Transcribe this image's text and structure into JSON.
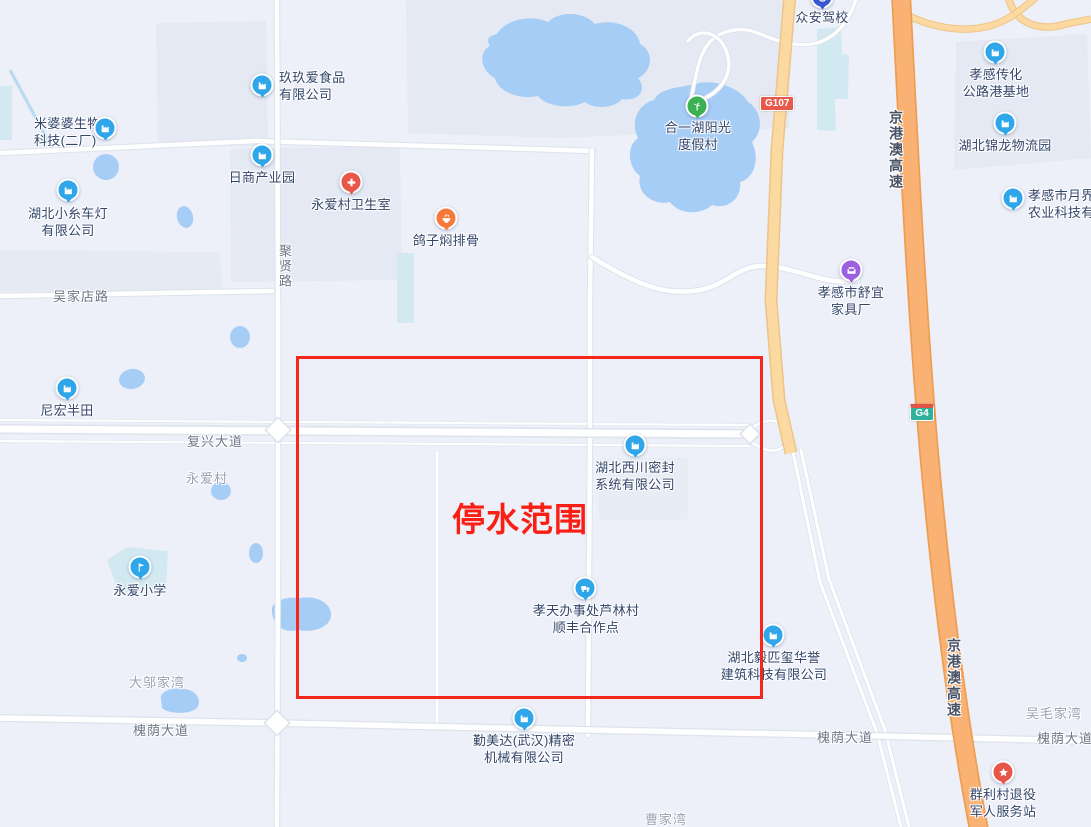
{
  "map": {
    "annotation": {
      "text": "停水范围",
      "color": "#f5261c"
    },
    "shields": [
      {
        "text": "G107"
      },
      {
        "text": "G4"
      }
    ],
    "road_labels": [
      {
        "text": "聚贤路"
      },
      {
        "text": "吴家店路"
      },
      {
        "text": "复兴大道"
      },
      {
        "text": "槐荫大道"
      },
      {
        "text": "槐荫大道"
      },
      {
        "text": "槐荫大道"
      },
      {
        "text": "京港澳高速"
      },
      {
        "text": "京港澳高速"
      }
    ],
    "area_labels": [
      {
        "text": "永爱村"
      },
      {
        "text": "大邬家湾"
      },
      {
        "text": "曹家湾"
      },
      {
        "text": "吴毛家湾"
      }
    ],
    "pois": [
      {
        "name": "玖玖爱食品有限公司",
        "lines": [
          "玖玖爱食品",
          "有限公司"
        ],
        "icon": "factory-icon",
        "color": "#2fa6e9"
      },
      {
        "name": "米婆婆生物科技(二厂)",
        "lines": [
          "米婆婆生物",
          "科技(二厂)"
        ],
        "icon": "factory-icon",
        "color": "#2fa6e9"
      },
      {
        "name": "日商产业园",
        "lines": [
          "日商产业园"
        ],
        "icon": "factory-icon",
        "color": "#2fa6e9"
      },
      {
        "name": "湖北小糸车灯有限公司",
        "lines": [
          "湖北小糸车灯",
          "有限公司"
        ],
        "icon": "factory-icon",
        "color": "#2fa6e9"
      },
      {
        "name": "永爱村卫生室",
        "lines": [
          "永爱村卫生室"
        ],
        "icon": "clinic-cross-icon",
        "color": "#e8564a"
      },
      {
        "name": "鸽子焖排骨",
        "lines": [
          "鸽子焖排骨"
        ],
        "icon": "food-bowl-icon",
        "color": "#f5793b"
      },
      {
        "name": "合一湖阳光度假村",
        "lines": [
          "合一湖阳光",
          "度假村"
        ],
        "icon": "palm-tree-icon",
        "color": "#3db054"
      },
      {
        "name": "众安驾校",
        "lines": [
          "众安驾校"
        ],
        "icon": "steering-wheel-icon",
        "color": "#3b57cf"
      },
      {
        "name": "孝感传化公路港基地",
        "lines": [
          "孝感传化",
          "公路港基地"
        ],
        "icon": "factory-icon",
        "color": "#2fa6e9"
      },
      {
        "name": "湖北锦龙物流园",
        "lines": [
          "湖北锦龙物流园"
        ],
        "icon": "factory-icon",
        "color": "#2fa6e9"
      },
      {
        "name": "孝感市月界生农业科技有限",
        "lines": [
          "孝感市月界生",
          "农业科技有限"
        ],
        "icon": "factory-icon",
        "color": "#2fa6e9"
      },
      {
        "name": "孝感市舒宜家具厂",
        "lines": [
          "孝感市舒宜",
          "家具厂"
        ],
        "icon": "furniture-icon",
        "color": "#9b5fe0"
      },
      {
        "name": "尼宏半田",
        "lines": [
          "尼宏半田"
        ],
        "icon": "factory-icon",
        "color": "#2fa6e9"
      },
      {
        "name": "永爱小学",
        "lines": [
          "永爱小学"
        ],
        "icon": "school-flag-icon",
        "color": "#2fa6e9"
      },
      {
        "name": "湖北西川密封系统有限公司",
        "lines": [
          "湖北西川密封",
          "系统有限公司"
        ],
        "icon": "factory-icon",
        "color": "#2fa6e9"
      },
      {
        "name": "孝天办事处芦林村顺丰合作点",
        "lines": [
          "孝天办事处芦林村",
          "顺丰合作点"
        ],
        "icon": "truck-icon",
        "color": "#2fa6e9"
      },
      {
        "name": "湖北毅匹玺华誉建筑科技有限公司",
        "lines": [
          "湖北毅匹玺华誉",
          "建筑科技有限公司"
        ],
        "icon": "factory-icon",
        "color": "#2fa6e9"
      },
      {
        "name": "勤美达(武汉)精密机械有限公司",
        "lines": [
          "勤美达(武汉)精密",
          "机械有限公司"
        ],
        "icon": "factory-icon",
        "color": "#2fa6e9"
      },
      {
        "name": "群利村退役军人服务站",
        "lines": [
          "群利村退役",
          "军人服务站"
        ],
        "icon": "star-icon",
        "color": "#e8564a"
      }
    ]
  }
}
